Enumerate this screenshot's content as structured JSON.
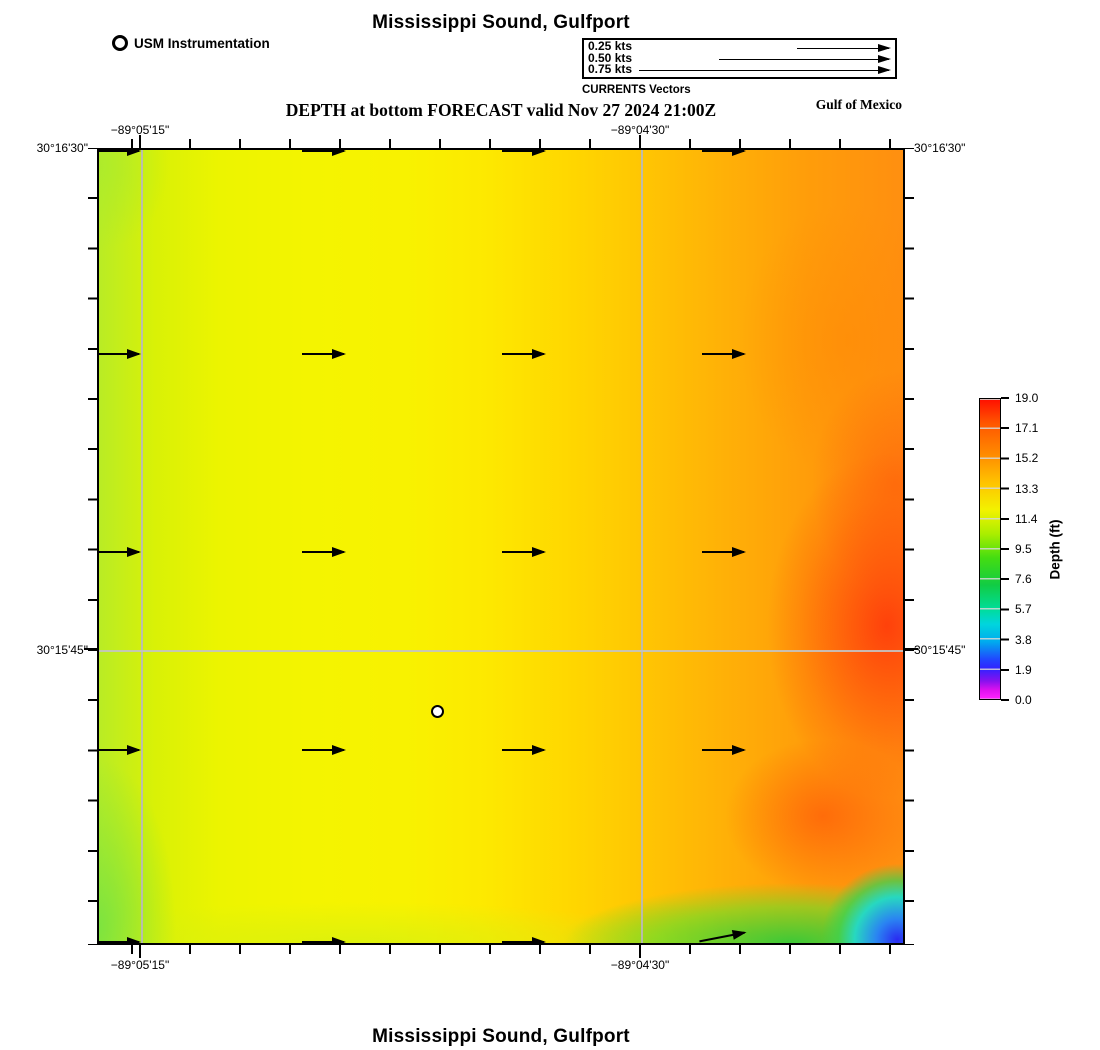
{
  "figure": {
    "title_top": "Mississippi Sound, Gulfport",
    "subtitle": "DEPTH at bottom FORECAST valid Nov 27 2024 21:00Z",
    "region_label": "Gulf of Mexico",
    "title_bottom": "Mississippi Sound, Gulfport"
  },
  "legend": {
    "station_label": "USM Instrumentation",
    "currents_caption": "CURRENTS Vectors",
    "speeds": [
      "0.25 kts",
      "0.50 kts",
      "0.75 kts"
    ]
  },
  "axes": {
    "lon_west": "−89°05'15\"",
    "lon_east": "−89°04'30\"",
    "lat_north": "30°16'30\"",
    "lat_south": "30°15'45\""
  },
  "colorbar": {
    "label": "Depth (ft)",
    "min": 0.0,
    "max": 19.0,
    "ticks": [
      "19.0",
      "17.1",
      "15.2",
      "13.3",
      "11.4",
      "9.5",
      "7.6",
      "5.7",
      "3.8",
      "1.9",
      "0.0"
    ],
    "colors_top_to_bottom": [
      "#ff0f00",
      "#ff8800",
      "#f2f200",
      "#44dd11",
      "#11cc44",
      "#00d5dd",
      "#00aaee",
      "#2244ff",
      "#8811ee",
      "#dd11ee",
      "#ff22ff"
    ]
  },
  "map": {
    "gridline_longitudes": [
      "−89°05'15\"",
      "−89°04'30\""
    ],
    "gridline_latitudes": [
      "30°15'45\""
    ],
    "current_vectors": {
      "direction": "east",
      "interior_rows": 3,
      "interior_cols": 4,
      "edge_rows_clipped": 2
    },
    "station_marker_count": 1
  }
}
